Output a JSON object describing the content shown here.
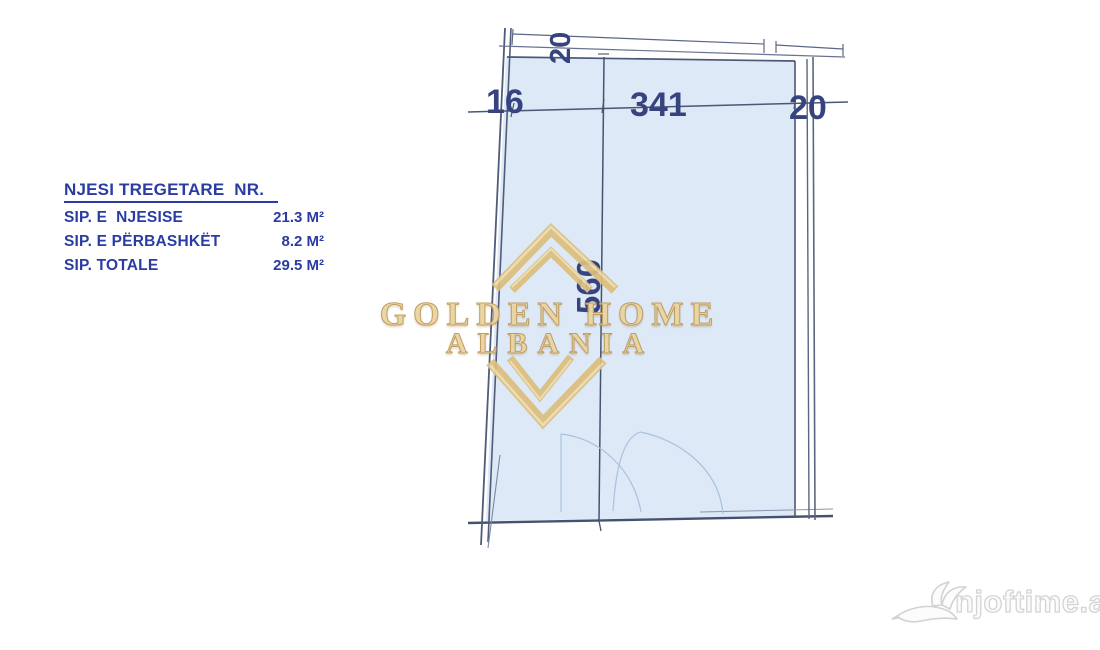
{
  "info_panel": {
    "title": "NJESI TREGETARE  NR.",
    "rows": [
      {
        "label": "SIP. E  NJESISE",
        "value": "21.3 M²"
      },
      {
        "label": "SIP. E PËRBASHKËT",
        "value": "8.2 M²"
      },
      {
        "label": "SIP. TOTALE",
        "value": "29.5 M²"
      }
    ]
  },
  "floorplan": {
    "dim_top_wall": "20",
    "dim_left": "16",
    "dim_width": "341",
    "dim_right_wall": "20",
    "dim_height": "560",
    "fill_color": "#dde9f6",
    "line_color": "#46536f",
    "dim_text_color": "#36437e"
  },
  "watermark": {
    "line1": "GOLDEN HOME",
    "line2": "ALBANIA",
    "color": "#dfc083"
  },
  "site_logo": {
    "text": "njoftime.al",
    "color": "#d6d6d6"
  }
}
